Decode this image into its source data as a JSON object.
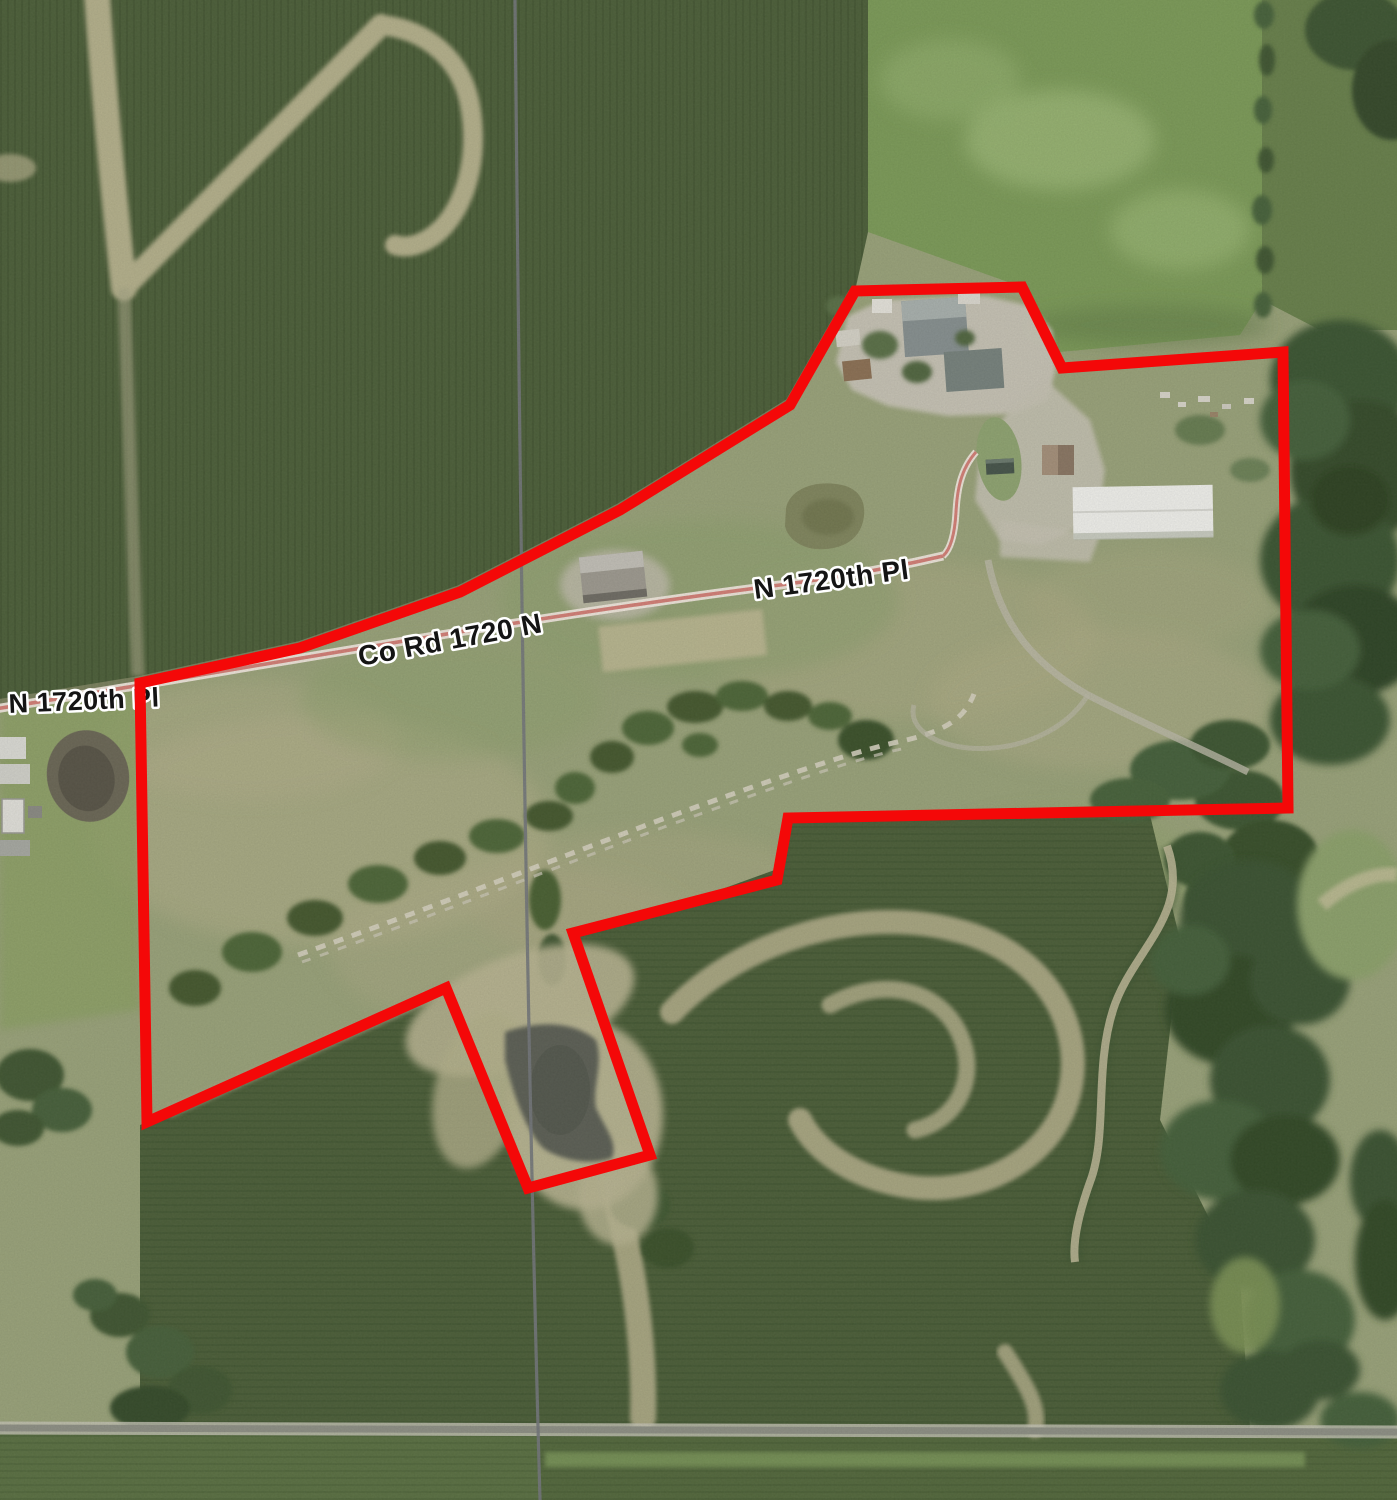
{
  "map": {
    "type": "aerial-parcel-map",
    "road_labels": {
      "left": "N 1720th Pl",
      "county_road": "Co Rd 1720 N",
      "center": "N 1720th Pl"
    },
    "colors": {
      "parcel_boundary": "#f40808",
      "road_centerline": "#d47f77",
      "road_casing": "#f2e9df",
      "section_line": "#73777b",
      "label_text": "#141414",
      "label_halo": "#ffffff"
    }
  }
}
